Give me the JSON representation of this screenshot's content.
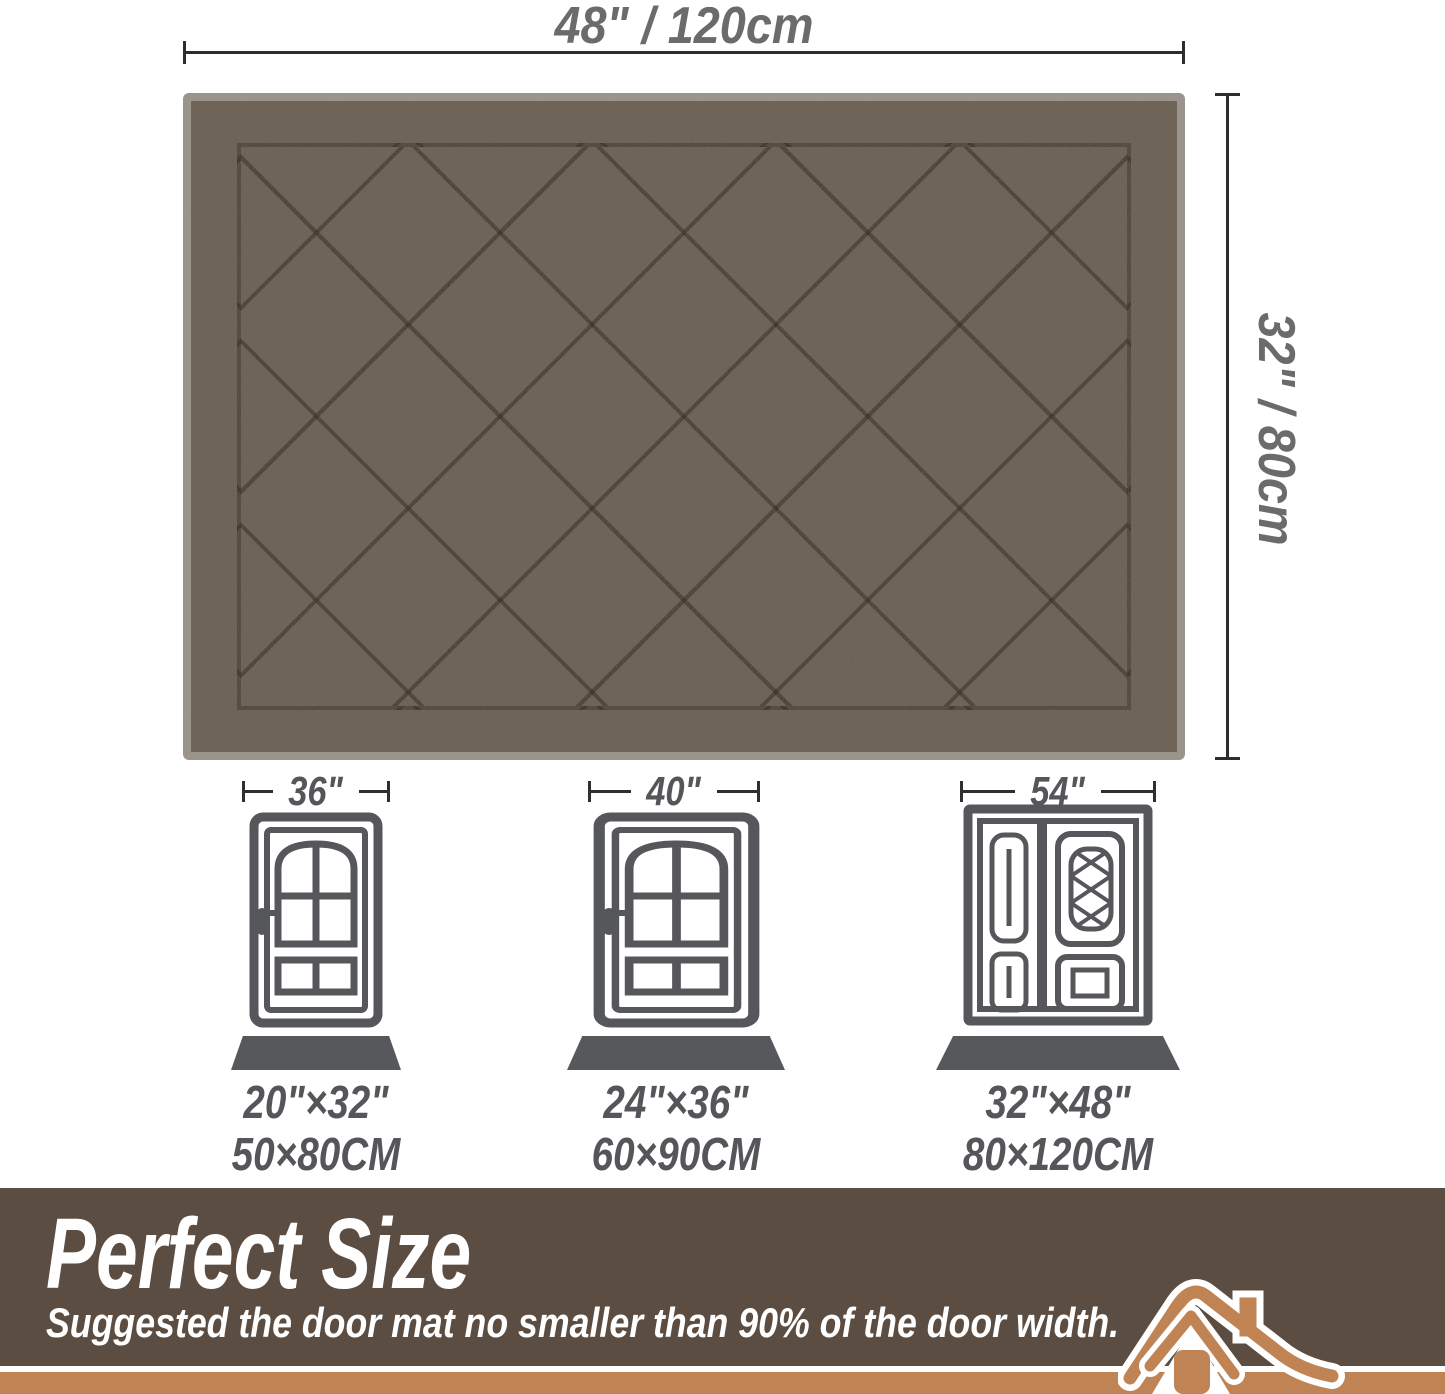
{
  "colors": {
    "mat_surface": "#71665a",
    "mat_binding": "#9b948c",
    "mat_pattern_line": "#2a2118",
    "dimension_line": "#2d2d2d",
    "dimension_text": "#6b6b6b",
    "door_icon_gray": "#56575a",
    "floor_mat_gray": "#57585b",
    "banner_background": "#5b4d42",
    "banner_accent_tan": "#bf8354",
    "banner_text": "#ffffff"
  },
  "mat": {
    "width_label": "48\" / 120cm",
    "height_label": "32\" / 80cm"
  },
  "doors": [
    {
      "type": "single",
      "door_width": "36\"",
      "mat_size_inches": "20\"×32\"",
      "mat_size_cm": "50×80CM"
    },
    {
      "type": "single",
      "door_width": "40\"",
      "mat_size_inches": "24\"×36\"",
      "mat_size_cm": "60×90CM"
    },
    {
      "type": "double",
      "door_width": "54\"",
      "mat_size_inches": "32\"×48\"",
      "mat_size_cm": "80×120CM"
    }
  ],
  "banner": {
    "title": "Perfect Size",
    "subtitle": "Suggested the door mat no smaller than 90% of the door width."
  }
}
